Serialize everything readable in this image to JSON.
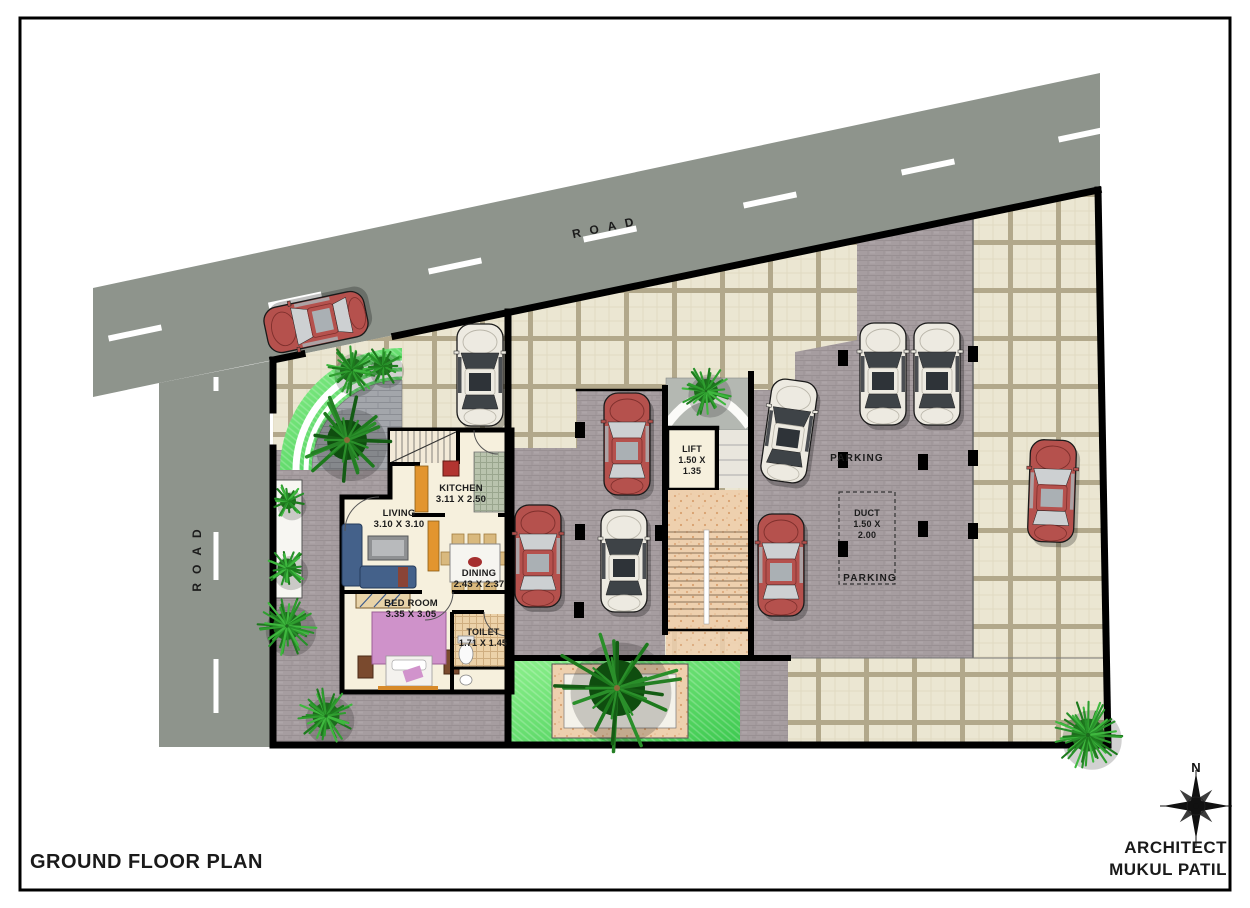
{
  "title_block": {
    "plan_title": "GROUND FLOOR PLAN",
    "architect_line1": "ARCHITECT",
    "architect_line2": "MUKUL PATIL",
    "north_label": "N"
  },
  "roads": {
    "top_label": "ROAD",
    "left_label": "ROAD"
  },
  "rooms": [
    {
      "id": "living",
      "lines": [
        "LIVING",
        "3.10 X 3.10"
      ],
      "x": 399,
      "y": 516,
      "fs": 9.5
    },
    {
      "id": "kitchen",
      "lines": [
        "KITCHEN",
        "3.11 X 2.50"
      ],
      "x": 461,
      "y": 491,
      "fs": 9.5
    },
    {
      "id": "dining",
      "lines": [
        "DINING",
        "2.43 X 2.37"
      ],
      "x": 479,
      "y": 576,
      "fs": 9.5
    },
    {
      "id": "bedroom",
      "lines": [
        "BED ROOM",
        "3.35 X 3.05"
      ],
      "x": 411,
      "y": 606,
      "fs": 9.5
    },
    {
      "id": "toilet",
      "lines": [
        "TOILET",
        "1.71 X 1.45"
      ],
      "x": 483,
      "y": 635,
      "fs": 9
    },
    {
      "id": "lift",
      "lines": [
        "LIFT",
        "1.50 X",
        "1.35"
      ],
      "x": 692,
      "y": 452,
      "fs": 9
    },
    {
      "id": "duct",
      "lines": [
        "DUCT",
        "1.50 X",
        "2.00"
      ],
      "x": 867,
      "y": 516,
      "fs": 9
    },
    {
      "id": "parking-1",
      "lines": [
        "PARKING"
      ],
      "x": 857,
      "y": 461,
      "fs": 10
    },
    {
      "id": "parking-2",
      "lines": [
        "PARKING"
      ],
      "x": 870,
      "y": 581,
      "fs": 10
    }
  ],
  "cars": [
    {
      "color": "red",
      "x": 316,
      "y": 322,
      "angle": 258
    },
    {
      "color": "white",
      "x": 480,
      "y": 375,
      "angle": 0
    },
    {
      "color": "red",
      "x": 627,
      "y": 444,
      "angle": 0
    },
    {
      "color": "red",
      "x": 538,
      "y": 556,
      "angle": 0
    },
    {
      "color": "white",
      "x": 624,
      "y": 561,
      "angle": 0
    },
    {
      "color": "white",
      "x": 789,
      "y": 431,
      "angle": 8
    },
    {
      "color": "red",
      "x": 781,
      "y": 565,
      "angle": 0
    },
    {
      "color": "white",
      "x": 883,
      "y": 374,
      "angle": 0
    },
    {
      "color": "white",
      "x": 937,
      "y": 374,
      "angle": 0
    },
    {
      "color": "red",
      "x": 1052,
      "y": 491,
      "angle": 2
    }
  ],
  "trees": [
    {
      "x": 352,
      "y": 370,
      "r": 24,
      "type": "bush"
    },
    {
      "x": 383,
      "y": 366,
      "r": 19,
      "type": "bush"
    },
    {
      "x": 347,
      "y": 440,
      "r": 40,
      "type": "palm"
    },
    {
      "x": 288,
      "y": 501,
      "r": 16,
      "type": "bush"
    },
    {
      "x": 287,
      "y": 568,
      "r": 19,
      "type": "bush"
    },
    {
      "x": 287,
      "y": 626,
      "r": 28,
      "type": "round"
    },
    {
      "x": 326,
      "y": 716,
      "r": 27,
      "type": "round"
    },
    {
      "x": 706,
      "y": 391,
      "r": 24,
      "type": "bush"
    },
    {
      "x": 617,
      "y": 688,
      "r": 56,
      "type": "palm"
    },
    {
      "x": 1088,
      "y": 735,
      "r": 33,
      "type": "round"
    }
  ],
  "columns": [
    {
      "x": 843,
      "y": 358
    },
    {
      "x": 973,
      "y": 354
    },
    {
      "x": 843,
      "y": 460
    },
    {
      "x": 923,
      "y": 462
    },
    {
      "x": 973,
      "y": 458
    },
    {
      "x": 843,
      "y": 549
    },
    {
      "x": 923,
      "y": 529
    },
    {
      "x": 973,
      "y": 531
    },
    {
      "x": 580,
      "y": 430
    },
    {
      "x": 580,
      "y": 532
    },
    {
      "x": 660,
      "y": 533
    },
    {
      "x": 579,
      "y": 610
    }
  ],
  "road_dashes": {
    "top": [
      {
        "x": 135,
        "y": 333
      },
      {
        "x": 295,
        "y": 300
      },
      {
        "x": 455,
        "y": 266
      },
      {
        "x": 610,
        "y": 234
      },
      {
        "x": 770,
        "y": 200
      },
      {
        "x": 928,
        "y": 167
      },
      {
        "x": 1085,
        "y": 134
      }
    ],
    "left": [
      {
        "x": 216,
        "y": 384,
        "len": 14
      },
      {
        "x": 216,
        "y": 556,
        "len": 48
      },
      {
        "x": 216,
        "y": 686,
        "len": 54
      }
    ]
  },
  "colors": {
    "road": "#8e948c",
    "paving_brick": "#a69da0",
    "tile": "#ebe6d2",
    "tile_grout": "#b2a88b",
    "lawn_light": "#8df08d",
    "lawn_dark": "#3cc94f",
    "wall": "#000000",
    "house_floor": "#f6f0dd",
    "stair": "#eed0ae",
    "bed_pink": "#cf92ca",
    "sofa_blue": "#44618a",
    "kitchen_counter": "#e2952f",
    "car_red": "#b5514d",
    "car_white": "#edeae1",
    "tree_green": "#2f9e2f",
    "label": "#1c1c1c"
  }
}
